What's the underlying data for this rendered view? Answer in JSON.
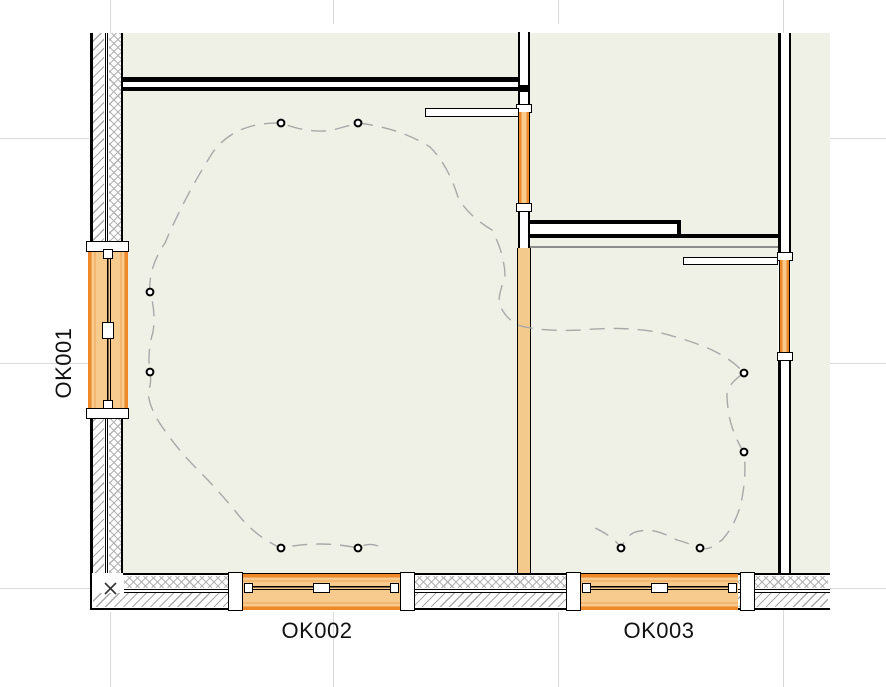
{
  "view": {
    "type": "floor-plan",
    "description": "2D CAD floor plan crop with two rooms, hatched exterior walls, windows and ceiling lamp wiring route"
  },
  "labels": {
    "ok001": "OK001",
    "ok002": "OK002",
    "ok003": "OK003"
  },
  "windows": [
    {
      "id": "OK001",
      "wall": "left-exterior",
      "orientation": "vertical"
    },
    {
      "id": "OK002",
      "wall": "bottom-exterior",
      "orientation": "horizontal"
    },
    {
      "id": "OK003",
      "wall": "bottom-exterior",
      "orientation": "horizontal"
    }
  ],
  "unlabeled_window_count": 2,
  "lamps": {
    "count": 10,
    "positions": [
      [
        281,
        123
      ],
      [
        358,
        123
      ],
      [
        150,
        292
      ],
      [
        150,
        372
      ],
      [
        281,
        548
      ],
      [
        358,
        548
      ],
      [
        744,
        373
      ],
      [
        744,
        452
      ],
      [
        621,
        548
      ],
      [
        700,
        548
      ]
    ]
  },
  "colors": {
    "floor": "#EFF1E6",
    "window_accent": "#EF8829",
    "window_fill": "#F7CA8E",
    "interior_wall_fill": "#F3C98C",
    "wall_line": "#000000",
    "hatch": "#A8A8A8",
    "grid_line": "#D9D9D9",
    "route_dash": "#A8A8A8"
  }
}
